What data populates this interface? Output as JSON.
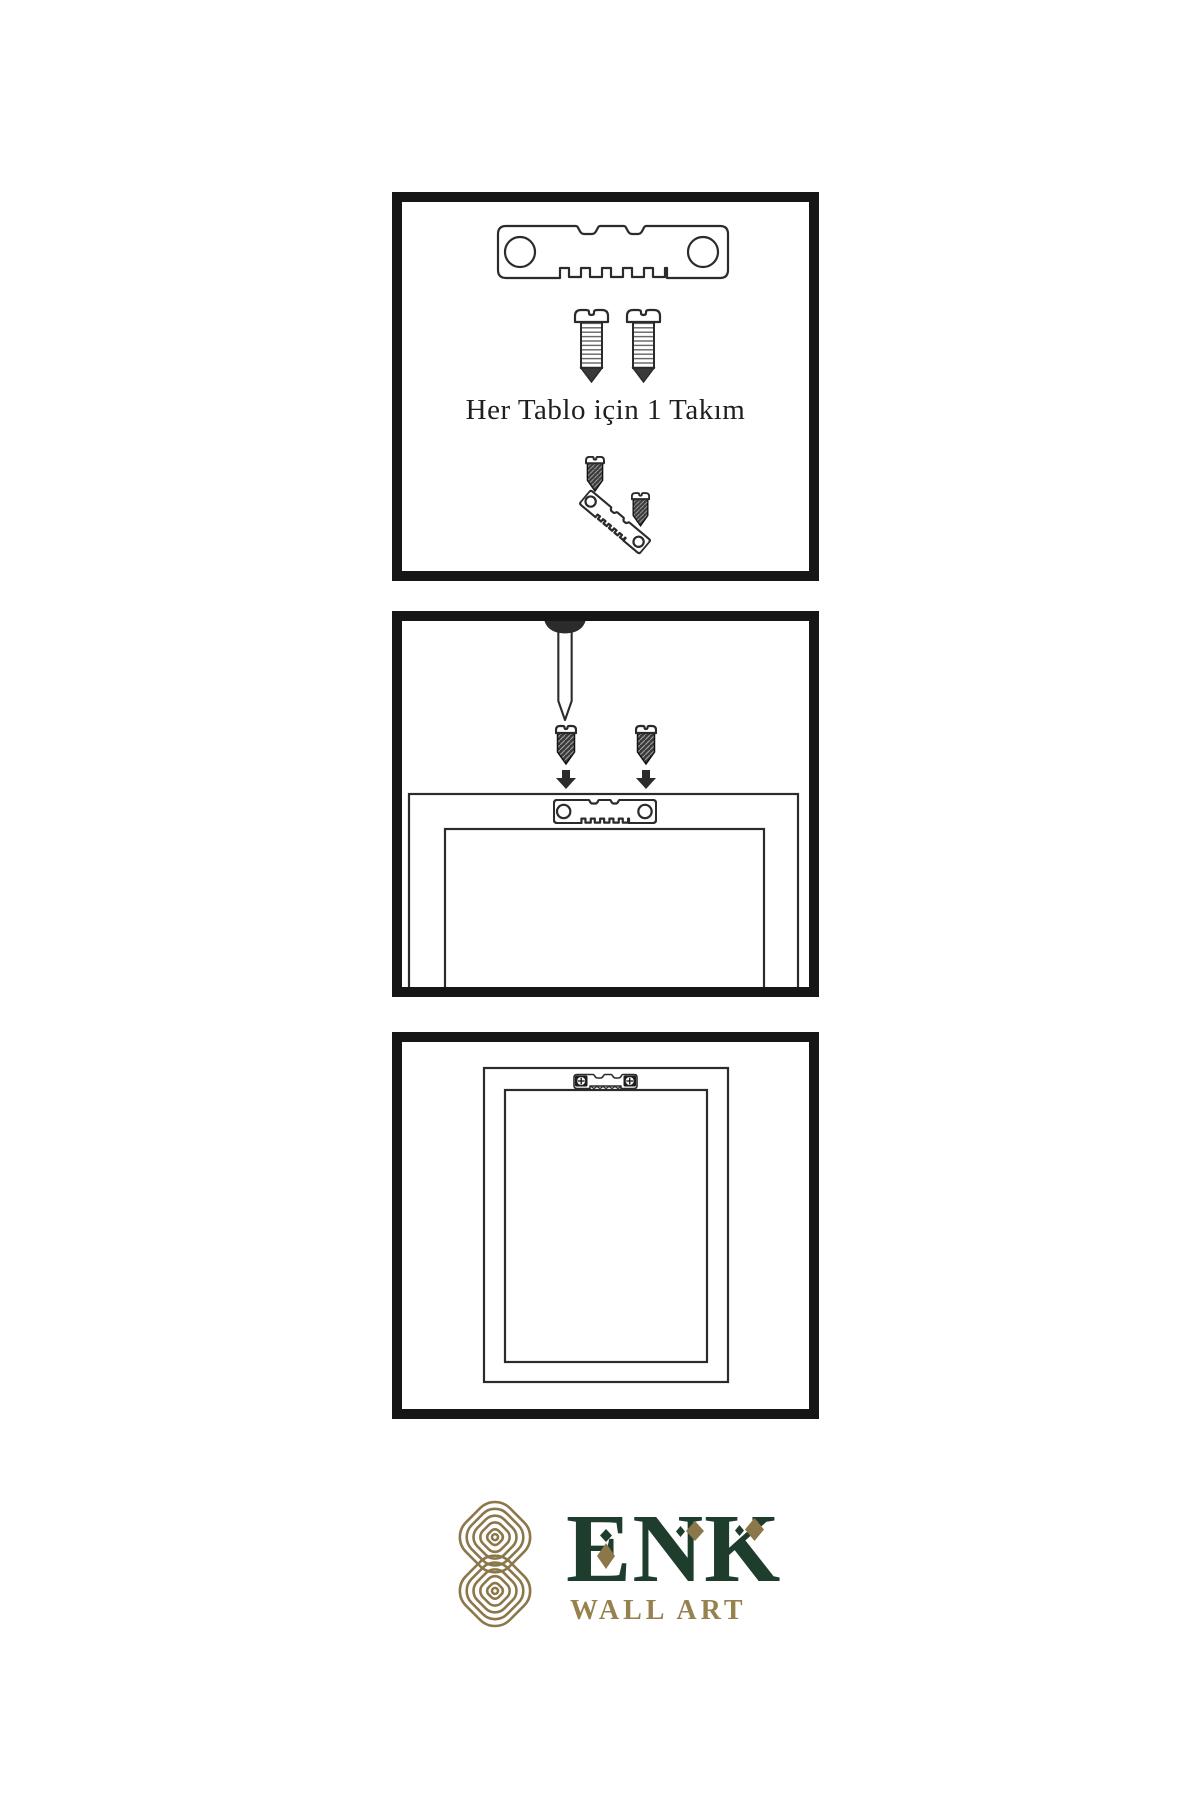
{
  "meta": {
    "type": "wall-art-hanging-instruction-sheet"
  },
  "colors": {
    "background": "#ffffff",
    "line_art": "#2b2b2b",
    "panel_border": "#161616",
    "brand_green": "#1e3d2d",
    "brand_gold": "#8c774a",
    "brand_gold_light": "#96814f"
  },
  "step1": {
    "caption": "Her Tablo için 1 Takım",
    "icons": [
      "sawtooth-hanger-icon",
      "screw-icon",
      "screw-icon",
      "screw-into-hanger-demo-icon"
    ]
  },
  "step2": {
    "icons": [
      "wall-nail-icon",
      "screw-icon",
      "down-arrow-icon",
      "screw-icon",
      "down-arrow-icon",
      "frame-back-with-sawtooth-hanger-icon"
    ]
  },
  "step3": {
    "icons": [
      "hung-frame-with-mounted-hanger-icon"
    ]
  },
  "brand": {
    "name": "ENK",
    "tagline": "WALL ART",
    "emblem": "knot-emblem-icon"
  }
}
